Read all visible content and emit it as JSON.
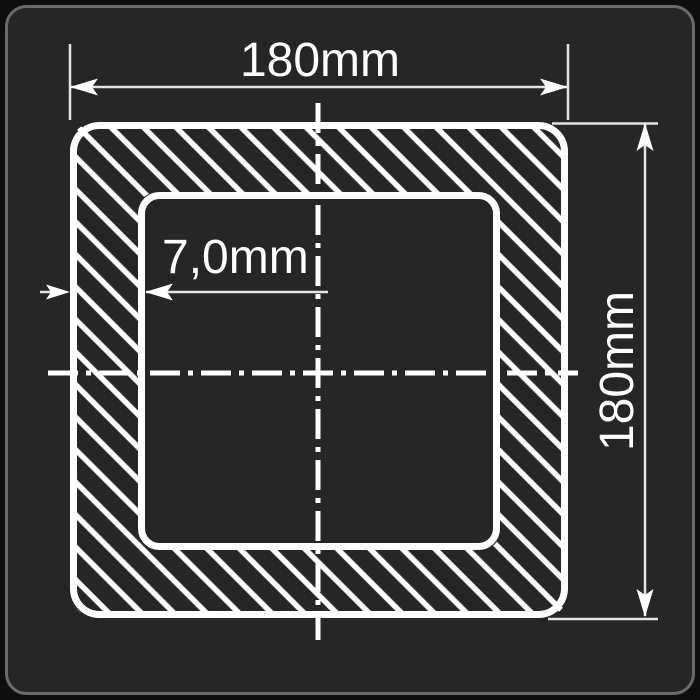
{
  "drawing": {
    "type": "technical-cross-section",
    "subject": "square hollow tube profile with hatched walls",
    "labels": {
      "width": "180mm",
      "height": "180mm",
      "wall_thickness": "7,0mm"
    },
    "dimensions_shown": {
      "outer_width_mm": 180,
      "outer_height_mm": 180,
      "wall_thickness_mm": 7.0
    },
    "colors": {
      "page_background": "#0e0e0e",
      "card_background": "#262626",
      "card_border": "#6a6a6a",
      "drawing_lines": "#ffffff",
      "thin_dimension_lines": "#e3e3e3"
    },
    "style_notes": {
      "hatching": "diagonal 45-degree white hatch between outer and inner profile",
      "centerlines": "dash-dot horizontal and vertical centerlines crossing at profile center"
    }
  }
}
